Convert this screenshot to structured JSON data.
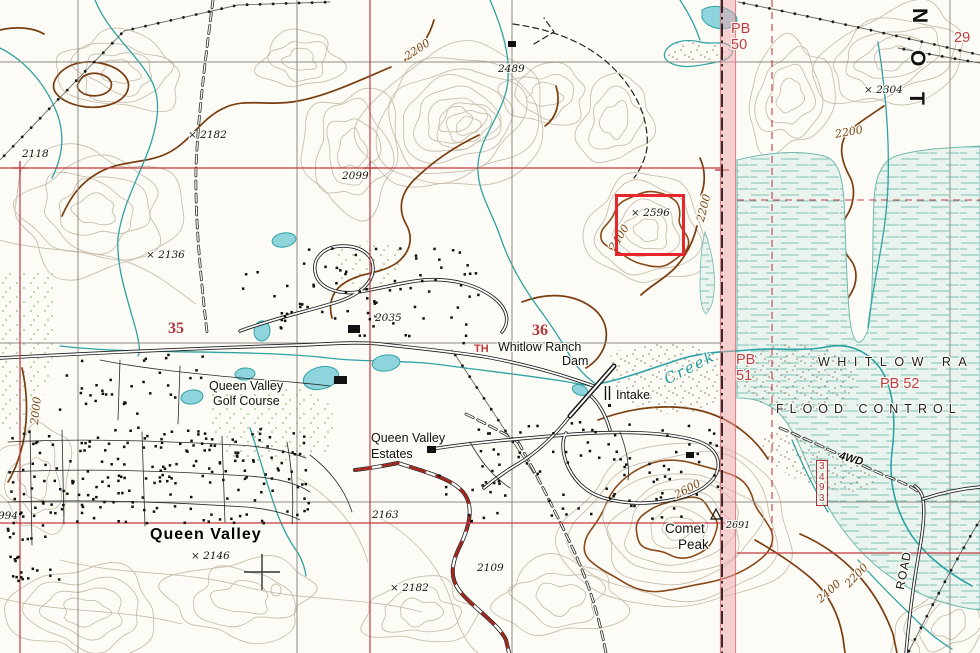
{
  "colors": {
    "paper": "#fcfbf5",
    "contour_light": "#c6bcab",
    "contour_index": "#8a4a1a",
    "water": "#2ea3a3",
    "pond_fill": "#8fd3dc",
    "grid_gray": "#8f8a82",
    "grid_red": "#c23b42",
    "band_pink": "#f0a5ab",
    "road_red": "#a8231a",
    "highlight_red": "#e8262c",
    "basin_bg": "#eaf4ee",
    "basin_dash": "#7fc0b4",
    "label_red": "#c23b42",
    "label_brown": "#7a4415",
    "creek_blue": "#1d9a9a"
  },
  "labels": {
    "spot_2118": "2118",
    "spot_2182_nw": "× 2182",
    "cont_2200_nw": "2200",
    "spot_2489": "2489",
    "spot_2099": "2099",
    "spot_2304": "× 2304",
    "cont_2200_ne": "2200",
    "pb50": "PB\n50",
    "sec_29": "29",
    "edge_letter_n": "N",
    "edge_letter_o": "O",
    "edge_letter_t": "T",
    "spot_2596": "× 2596",
    "cont_2400_hill": "2400",
    "cont_2200_hill": "2200",
    "spot_2136": "× 2136",
    "sec_35": "35",
    "spot_2035": "2035",
    "sec_36": "36",
    "trailhead": "TH",
    "dam_name_1": "Whitlow Ranch",
    "dam_name_2": "Dam",
    "creek": "Creek",
    "intake": "Intake",
    "pb51": "PB\n51",
    "whitlow_ra": "WHITLOW RA",
    "pb52": "PB 52",
    "flood_control": "FLOOD CONTROL",
    "trail_4wd": "4WD",
    "bm_3493": "3\n4\n9\n3",
    "golf_1": "Queen Valley",
    "golf_2": "Golf Course",
    "estates_1": "Queen Valley",
    "estates_2": "Estates",
    "spot_2163": "2163",
    "town": "Queen Valley",
    "spot_2146": "× 2146",
    "spot_2109": "2109",
    "spot_2182_s": "× 2182",
    "comet_1": "Comet",
    "comet_2": "Peak",
    "spot_2691": "2691",
    "cont_2600": "2600",
    "cont_2400_se": "2400",
    "cont_2200_se": "2200",
    "road_se": "ROAD",
    "spot_994": "994",
    "cont_2000": "2000"
  }
}
